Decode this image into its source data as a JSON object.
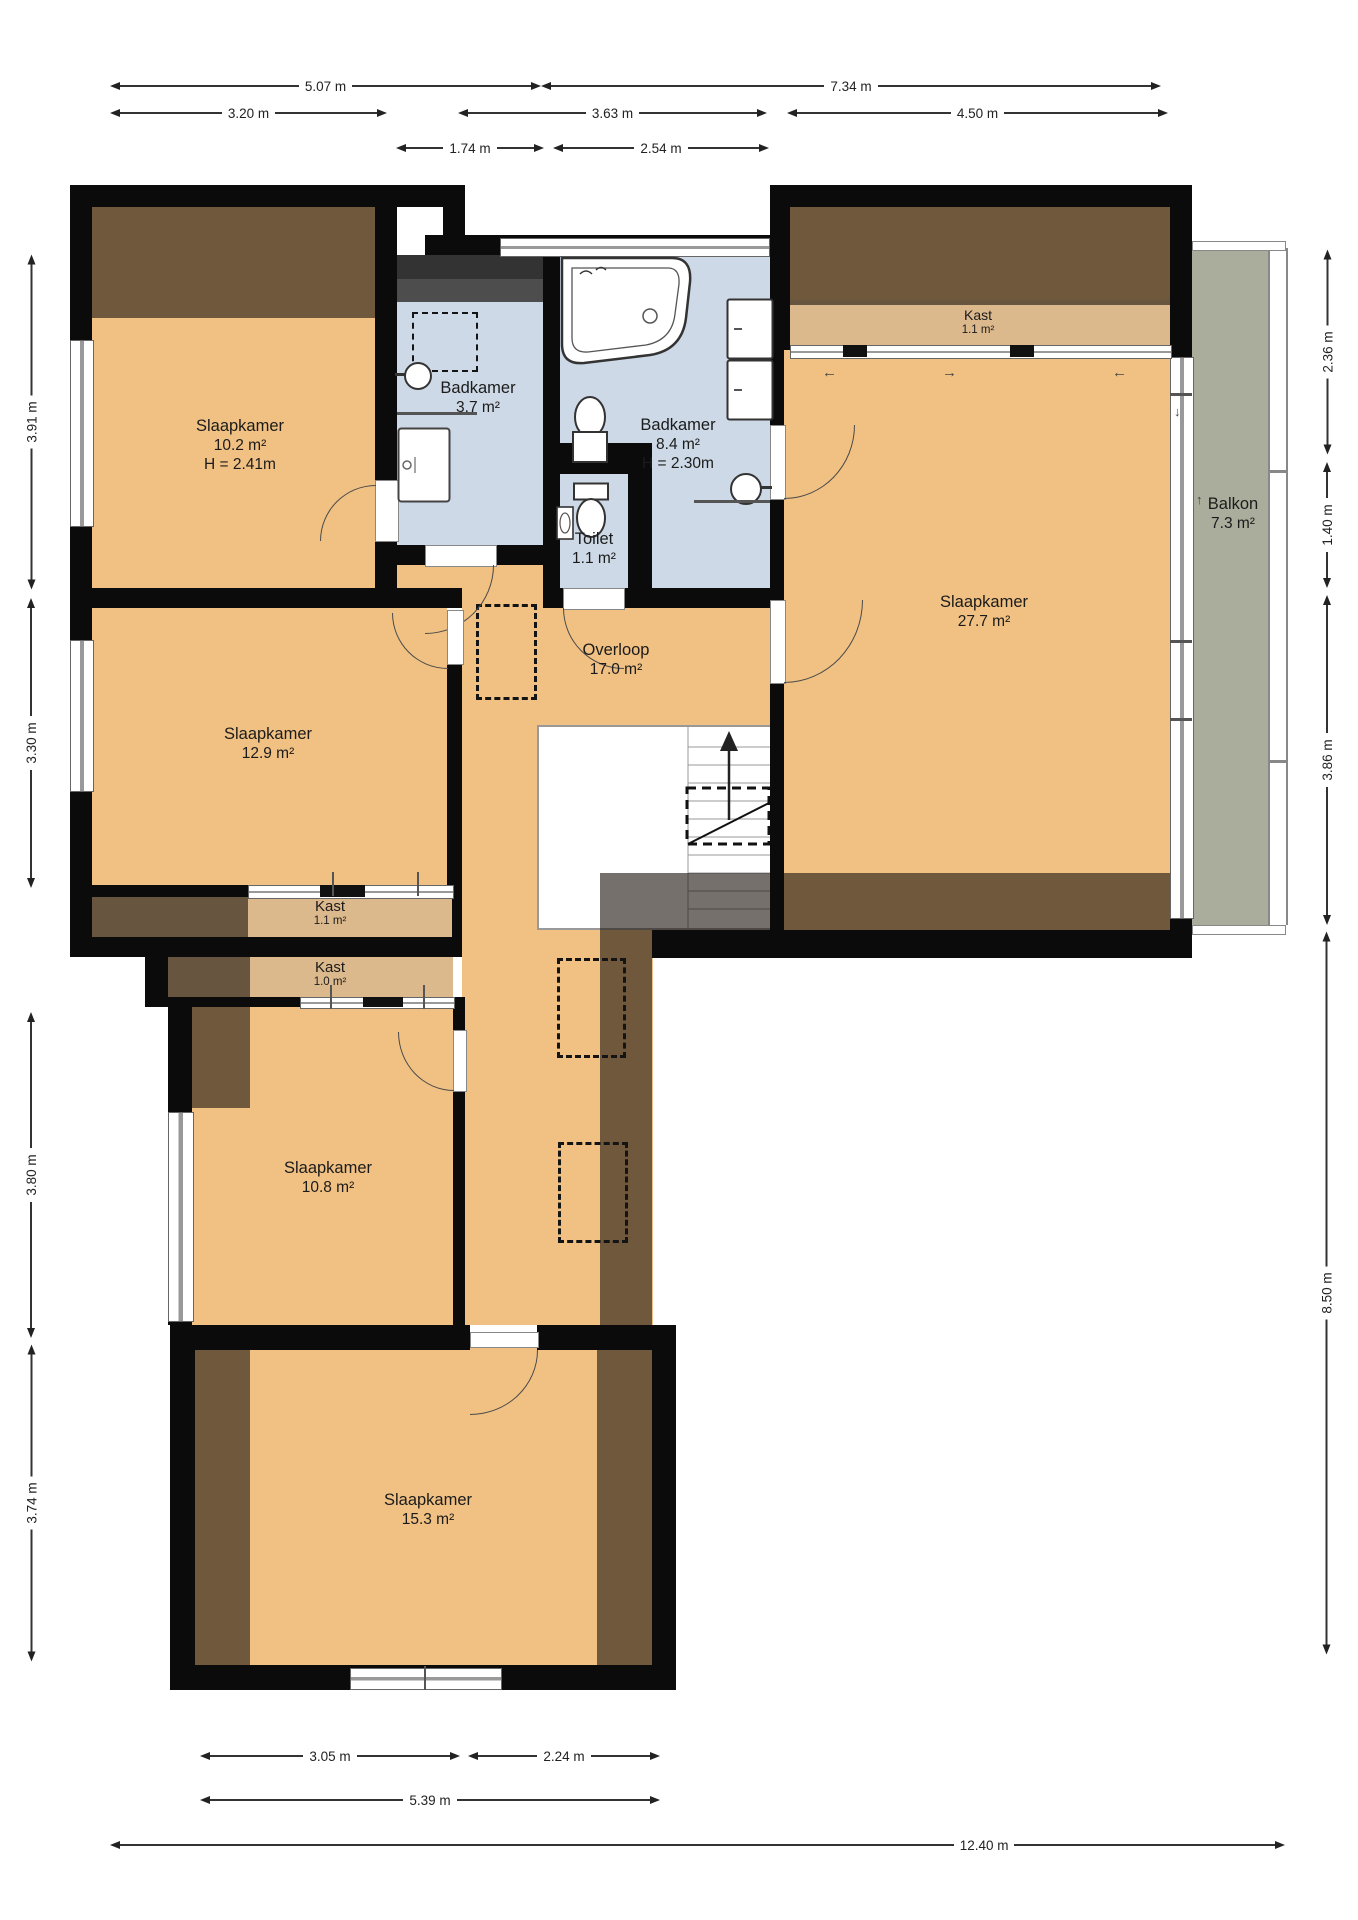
{
  "rooms": {
    "nw": {
      "name": "Slaapkamer",
      "area": "10.2 m²",
      "height": "H = 2.41m"
    },
    "bath_small": {
      "name": "Badkamer",
      "area": "3.7 m²"
    },
    "bath_large": {
      "name": "Badkamer",
      "area": "8.4 m²",
      "height": "H = 2.30m"
    },
    "toilet": {
      "name": "Toilet",
      "area": "1.1 m²"
    },
    "landing": {
      "name": "Overloop",
      "area": "17.0 m²"
    },
    "closet_ne": {
      "name": "Kast",
      "area": "1.1 m²"
    },
    "east": {
      "name": "Slaapkamer",
      "area": "27.7 m²"
    },
    "balcony": {
      "name": "Balkon",
      "area": "7.3 m²"
    },
    "west": {
      "name": "Slaapkamer",
      "area": "12.9 m²"
    },
    "closet_w1": {
      "name": "Kast",
      "area": "1.1 m²"
    },
    "closet_w2": {
      "name": "Kast",
      "area": "1.0 m²"
    },
    "sw": {
      "name": "Slaapkamer",
      "area": "10.8 m²"
    },
    "south": {
      "name": "Slaapkamer",
      "area": "15.3 m²"
    }
  },
  "dims": {
    "t1": [
      "5.07 m",
      "7.34 m"
    ],
    "t2": [
      "3.20 m",
      "3.63 m",
      "4.50 m"
    ],
    "t3": [
      "1.74 m",
      "2.54 m"
    ],
    "left": [
      "3.91 m",
      "3.30 m",
      "3.80 m",
      "3.74 m"
    ],
    "right": [
      "2.36 m",
      "1.40 m",
      "3.86 m",
      "8.50 m"
    ],
    "b1": [
      "3.05 m",
      "2.24 m"
    ],
    "b2": [
      "5.39 m"
    ],
    "b3": [
      "12.40 m"
    ]
  },
  "icons": {
    "arrow_left": "←",
    "arrow_right": "→",
    "arrow_up": "↑",
    "arrow_down": "↓"
  },
  "colors": {
    "floor": "#f0c183",
    "closet": "#dcb98d",
    "bath": "#cdd9e6",
    "balcony": "#aaad9b",
    "wall": "#0b0b0b"
  }
}
